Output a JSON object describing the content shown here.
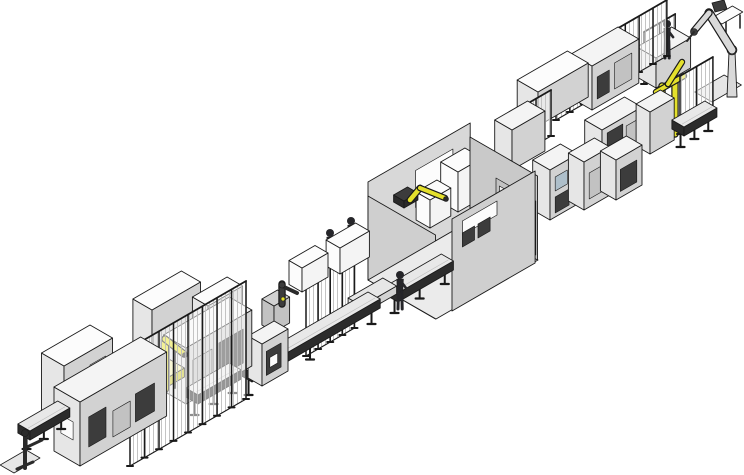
{
  "scene": {
    "kind": "isometric-cad-render",
    "subject": "automated production assembly line",
    "canvas_width": 744,
    "canvas_height": 475,
    "background": "#ffffff"
  },
  "palette": {
    "ink": "#1a1a1a",
    "top": "#f4f4f4",
    "end": "#e6e6e6",
    "long": "#d2d2d2",
    "longDark": "#c2c2c2",
    "white": "#fcfcfc",
    "dark": "#3c3c3c",
    "darker": "#2a2a2a",
    "wall": "#d8d8d8",
    "wallSide": "#c9c9c9",
    "wallFront": "#cfcfcf",
    "floor": "#ebebeb",
    "belt": "#e8e8e8",
    "frame": "#2c2c2c",
    "yellow": "#e4e02c",
    "yellowDark": "#c9c52a",
    "paleYellow": "#f2f0aa",
    "metal": "#d9d9d9",
    "screen": "#aebfca",
    "figure": "#26262a",
    "meshLine": "#bdbdbd"
  },
  "elements": [
    {
      "id": "safety-frame-top",
      "type": "fence",
      "o": [
        644,
        84
      ],
      "l": 36,
      "h": 52
    },
    {
      "id": "operator-platform",
      "type": "box",
      "o": [
        656,
        88
      ],
      "l": 40,
      "t": 22,
      "h": 30
    },
    {
      "id": "top-operator-figure",
      "type": "figure",
      "p": [
        667,
        58
      ],
      "hgt": 38
    },
    {
      "id": "side-table-leg-1",
      "type": "seg",
      "pts": [
        [
          726,
          34
        ],
        [
          726,
          21
        ]
      ],
      "w": 1.5,
      "c": "ink"
    },
    {
      "id": "side-table-leg-2",
      "type": "seg",
      "pts": [
        [
          740,
          28
        ],
        [
          740,
          15
        ]
      ],
      "w": 1.5,
      "c": "ink"
    },
    {
      "id": "side-table-top",
      "type": "plate",
      "o": [
        722,
        24
      ],
      "l": 24,
      "t": 12,
      "c": "white"
    },
    {
      "id": "pedestal-robot-base-plate",
      "type": "plate",
      "o": [
        712,
        102
      ],
      "l": 34,
      "t": 20,
      "c": "end"
    },
    {
      "id": "pedestal-robot-column",
      "type": "quad",
      "pts": [
        [
          727,
          97
        ],
        [
          737,
          97
        ],
        [
          735,
          52
        ],
        [
          729,
          52
        ]
      ],
      "c": "metal"
    },
    {
      "id": "pedestal-robot-shoulder",
      "type": "circle",
      "p": [
        732,
        50
      ],
      "r": 5,
      "c": "long"
    },
    {
      "id": "pedestal-robot-upper-arm",
      "type": "oseg",
      "pts": [
        [
          732,
          50
        ],
        [
          709,
          13
        ]
      ],
      "w": 7,
      "c": "metal"
    },
    {
      "id": "pedestal-robot-counterweight",
      "type": "quad",
      "pts": [
        [
          712,
          3
        ],
        [
          724,
          0
        ],
        [
          727,
          9
        ],
        [
          715,
          12
        ]
      ],
      "c": "dark"
    },
    {
      "id": "pedestal-robot-forearm",
      "type": "oseg",
      "pts": [
        [
          709,
          13
        ],
        [
          694,
          31
        ]
      ],
      "w": 5,
      "c": "metal"
    },
    {
      "id": "pedestal-robot-wrist",
      "type": "circle",
      "p": [
        694,
        32
      ],
      "r": 3.5,
      "c": "dark"
    },
    {
      "id": "pedestal-robot-tool",
      "type": "seg",
      "pts": [
        [
          694,
          32
        ],
        [
          687,
          41
        ]
      ],
      "w": 2,
      "c": "darker"
    },
    {
      "id": "upper-fence-row",
      "type": "fence",
      "o": [
        556,
        120
      ],
      "l": 128,
      "h": 56
    },
    {
      "id": "upper-module-rear",
      "type": "box",
      "o": [
        592,
        110
      ],
      "l": 54,
      "t": 24,
      "h": 44,
      "panels": [
        {
          "f": "a",
          "r": [
            6,
            8,
            20,
            30
          ],
          "c": "dark"
        },
        {
          "f": "a",
          "r": [
            26,
            8,
            46,
            34
          ],
          "c": "longDark"
        }
      ]
    },
    {
      "id": "gantry-base",
      "type": "box",
      "o": [
        652,
        148
      ],
      "l": 34,
      "t": 18,
      "h": 10,
      "c": {
        "top": "paleYellow",
        "end": "paleYellow",
        "long": "yellowDark"
      }
    },
    {
      "id": "gantry-column-1",
      "type": "yseg",
      "pts": [
        [
          662,
          140
        ],
        [
          662,
          86
        ]
      ],
      "w": 5
    },
    {
      "id": "gantry-column-2",
      "type": "yseg",
      "pts": [
        [
          675,
          134
        ],
        [
          675,
          80
        ]
      ],
      "w": 5
    },
    {
      "id": "gantry-crossbar",
      "type": "yseg",
      "pts": [
        [
          656,
          92
        ],
        [
          684,
          76
        ]
      ],
      "w": 4
    },
    {
      "id": "gantry-joint",
      "type": "circle",
      "p": [
        668,
        84
      ],
      "r": 3,
      "c": "darker"
    },
    {
      "id": "gantry-arm",
      "type": "yseg",
      "pts": [
        [
          668,
          84
        ],
        [
          682,
          62
        ]
      ],
      "w": 4
    },
    {
      "id": "upper-module-front",
      "type": "box",
      "o": [
        538,
        126
      ],
      "l": 58,
      "t": 24,
      "h": 34,
      "c": {
        "top": "white"
      }
    },
    {
      "id": "safety-frame-right",
      "type": "fence",
      "o": [
        680,
        134
      ],
      "l": 38,
      "h": 58
    },
    {
      "id": "upper-cabinet-doors",
      "type": "box",
      "o": [
        602,
        172
      ],
      "l": 46,
      "t": 20,
      "h": 42,
      "panels": [
        {
          "f": "a",
          "r": [
            6,
            4,
            24,
            36
          ],
          "c": "dark"
        },
        {
          "f": "a",
          "r": [
            28,
            6,
            42,
            32
          ],
          "c": "longDark"
        }
      ]
    },
    {
      "id": "upper-cabinet-small",
      "type": "box",
      "o": [
        650,
        154
      ],
      "l": 28,
      "t": 16,
      "h": 42
    },
    {
      "id": "upper-conveyor",
      "type": "conveyor",
      "o": [
        684,
        152
      ],
      "l": 38,
      "z": 16
    },
    {
      "id": "behind-room-fence",
      "type": "fence",
      "o": [
        506,
        162
      ],
      "l": 52,
      "h": 46
    },
    {
      "id": "behind-room-module",
      "type": "box",
      "o": [
        512,
        170
      ],
      "l": 38,
      "t": 20,
      "h": 40
    },
    {
      "id": "screen-cabinet",
      "type": "box",
      "o": [
        550,
        220
      ],
      "l": 32,
      "t": 20,
      "h": 50,
      "panels": [
        {
          "f": "a",
          "r": [
            6,
            26,
            20,
            40
          ],
          "c": "screen"
        },
        {
          "f": "a",
          "r": [
            6,
            4,
            22,
            20
          ],
          "c": "dark"
        }
      ]
    },
    {
      "id": "outfeed-cabinet-1",
      "type": "box",
      "o": [
        584,
        210
      ],
      "l": 30,
      "t": 18,
      "h": 48,
      "panels": [
        {
          "f": "a",
          "r": [
            6,
            8,
            22,
            34
          ],
          "c": "longDark"
        }
      ]
    },
    {
      "id": "outfeed-cabinet-2",
      "type": "box",
      "o": [
        616,
        200
      ],
      "l": 30,
      "t": 18,
      "h": 40,
      "panels": [
        {
          "f": "a",
          "r": [
            5,
            6,
            24,
            28
          ],
          "c": "dark"
        }
      ]
    },
    {
      "id": "room-back-wall",
      "type": "wallA",
      "o": [
        368,
        280
      ],
      "l": 118,
      "h": 98,
      "c": "wall",
      "windows": [
        {
          "r": [
            55,
            45,
            98,
            82
          ],
          "c": "white"
        }
      ]
    },
    {
      "id": "room-left-wall",
      "type": "wallB",
      "o": [
        368,
        280
      ],
      "t": 78,
      "h": 84,
      "c": "wallFront"
    },
    {
      "id": "room-floor",
      "type": "quad",
      "pts": [
        [
          368,
          280
        ],
        [
          470,
          221
        ],
        [
          538,
          260
        ],
        [
          436,
          319
        ]
      ],
      "c": "floor"
    },
    {
      "id": "room-box-tall",
      "type": "box",
      "o": [
        458,
        212
      ],
      "l": 28,
      "t": 20,
      "h": 40,
      "c": {
        "top": "white",
        "end": "white",
        "long": "top"
      }
    },
    {
      "id": "room-box-small",
      "type": "box",
      "o": [
        430,
        228
      ],
      "l": 24,
      "t": 16,
      "h": 28,
      "c": {
        "top": "white",
        "end": "white",
        "long": "top"
      }
    },
    {
      "id": "room-box-right",
      "type": "box",
      "o": [
        492,
        238
      ],
      "l": 30,
      "t": 20,
      "h": 36,
      "c": {
        "top": "white",
        "end": "white",
        "long": "top"
      }
    },
    {
      "id": "room-robot-base",
      "type": "box",
      "o": [
        404,
        208
      ],
      "l": 16,
      "t": 12,
      "h": 7,
      "c": {
        "top": "dark",
        "end": "darker",
        "long": "darker"
      }
    },
    {
      "id": "room-robot-link-1",
      "type": "yseg",
      "pts": [
        [
          410,
          200
        ],
        [
          420,
          188
        ]
      ],
      "w": 4.5
    },
    {
      "id": "room-robot-link-2",
      "type": "yseg",
      "pts": [
        [
          420,
          188
        ],
        [
          445,
          198
        ]
      ],
      "w": 4
    },
    {
      "id": "room-robot-wrist",
      "type": "circle",
      "p": [
        446,
        199
      ],
      "r": 2.5,
      "c": "darker"
    },
    {
      "id": "room-right-wall",
      "type": "wallB",
      "o": [
        470,
        221
      ],
      "t": 78,
      "h": 84,
      "c": "wallSide",
      "windows": [
        {
          "r": [
            30,
            4,
            52,
            58
          ],
          "c": "longDark"
        },
        {
          "r": [
            56,
            4,
            76,
            58
          ],
          "c": "longDark"
        },
        {
          "r": [
            34,
            28,
            48,
            52
          ],
          "c": "top"
        },
        {
          "r": [
            60,
            28,
            72,
            52
          ],
          "c": "top"
        }
      ]
    },
    {
      "id": "room-front-wall",
      "type": "wallA",
      "o": [
        452,
        311
      ],
      "l": 96,
      "h": 92,
      "c": "wallFront",
      "windows": [
        {
          "r": [
            12,
            70,
            52,
            84
          ],
          "c": "white"
        },
        {
          "r": [
            12,
            58,
            26,
            72
          ],
          "c": "dark"
        },
        {
          "r": [
            30,
            58,
            44,
            72
          ],
          "c": "dark"
        }
      ]
    },
    {
      "id": "room-infeed-conveyor",
      "type": "conveyor",
      "o": [
        398,
        318
      ],
      "l": 64,
      "z": 16
    },
    {
      "id": "operator-figure-3",
      "type": "figure",
      "p": [
        400,
        309
      ],
      "hgt": 38
    },
    {
      "id": "mid-fence",
      "type": "fence",
      "o": [
        306,
        356
      ],
      "l": 56,
      "h": 85
    },
    {
      "id": "operator-figure-2",
      "type": "figure",
      "p": [
        351,
        255
      ],
      "hgt": 38
    },
    {
      "id": "operator-figure-1",
      "type": "figure",
      "p": [
        330,
        267
      ],
      "hgt": 38
    },
    {
      "id": "bench-box-2",
      "type": "box",
      "o": [
        340,
        274
      ],
      "l": 34,
      "t": 16,
      "h": 26,
      "c": {
        "top": "white",
        "end": "white",
        "long": "top"
      }
    },
    {
      "id": "bench-box-1",
      "type": "box",
      "o": [
        302,
        292
      ],
      "l": 30,
      "t": 15,
      "h": 24,
      "c": {
        "top": "white",
        "end": "white",
        "long": "top"
      }
    },
    {
      "id": "walkway",
      "type": "box",
      "o": [
        362,
        314
      ],
      "l": 40,
      "t": 16,
      "h": 8,
      "c": {
        "top": "end"
      }
    },
    {
      "id": "turntable-robot-stand",
      "type": "box",
      "o": [
        274,
        332
      ],
      "l": 18,
      "t": 14,
      "h": 26,
      "c": {
        "top": "long",
        "end": "longDark",
        "long": "longDark"
      }
    },
    {
      "id": "turntable-robot-body",
      "type": "oseg",
      "pts": [
        [
          282,
          304
        ],
        [
          282,
          284
        ]
      ],
      "w": 5,
      "c": "dark"
    },
    {
      "id": "turntable-robot-arm",
      "type": "seg",
      "pts": [
        [
          282,
          286
        ],
        [
          297,
          293
        ]
      ],
      "w": 4,
      "c": "darker"
    },
    {
      "id": "turntable-robot-joint",
      "type": "circle",
      "p": [
        282,
        285
      ],
      "r": 3,
      "c": "dark"
    },
    {
      "id": "turntable-robot-marker",
      "type": "circle",
      "p": [
        283,
        299
      ],
      "r": 2,
      "c": "yellow"
    },
    {
      "id": "mid-conveyor",
      "type": "conveyor",
      "o": [
        252,
        400
      ],
      "l": 148,
      "z": 18
    },
    {
      "id": "mid-cabinet",
      "type": "box",
      "o": [
        262,
        386
      ],
      "l": 30,
      "t": 16,
      "h": 42,
      "panels": [
        {
          "f": "a",
          "r": [
            5,
            8,
            22,
            32
          ],
          "c": "dark"
        },
        {
          "f": "a",
          "r": [
            9,
            14,
            18,
            24
          ],
          "c": "white"
        }
      ]
    },
    {
      "id": "cell-cabinet-rear-1",
      "type": "box",
      "o": [
        152,
        366
      ],
      "l": 56,
      "t": 22,
      "h": 56,
      "c": {
        "top": "white"
      }
    },
    {
      "id": "cell-cabinet-rear-2",
      "type": "box",
      "o": [
        208,
        354
      ],
      "l": 40,
      "t": 18,
      "h": 48,
      "c": {
        "top": "white"
      }
    },
    {
      "id": "cell-station-cabinet",
      "type": "box",
      "o": [
        186,
        404
      ],
      "l": 76,
      "t": 26,
      "h": 56,
      "panels": [
        {
          "f": "a",
          "r": [
            8,
            10,
            30,
            40
          ],
          "c": "longDark"
        },
        {
          "f": "a",
          "r": [
            38,
            8,
            66,
            42
          ],
          "c": "dark"
        }
      ]
    },
    {
      "id": "cell-robot-base",
      "type": "box",
      "o": [
        148,
        398
      ],
      "l": 42,
      "t": 24,
      "h": 9,
      "c": {
        "top": "paleYellow",
        "end": "paleYellow",
        "long": "yellowDark"
      }
    },
    {
      "id": "cell-robot-post",
      "type": "seg",
      "pts": [
        [
          175,
          388
        ],
        [
          175,
          348
        ]
      ],
      "w": 2,
      "c": "darker"
    },
    {
      "id": "cell-robot-column",
      "type": "yseg",
      "pts": [
        [
          165,
          389
        ],
        [
          165,
          340
        ]
      ],
      "w": 6
    },
    {
      "id": "cell-robot-shoulder",
      "type": "circle",
      "p": [
        165,
        339
      ],
      "r": 3.5,
      "c": "darker"
    },
    {
      "id": "cell-robot-arm",
      "type": "yseg",
      "pts": [
        [
          165,
          339
        ],
        [
          184,
          354
        ]
      ],
      "w": 5
    },
    {
      "id": "cell-robot-wrist",
      "type": "circle",
      "p": [
        185,
        355
      ],
      "r": 2.5,
      "c": "darker"
    },
    {
      "id": "link-conveyor",
      "type": "conveyor",
      "o": [
        198,
        420
      ],
      "l": 50,
      "z": 16
    },
    {
      "id": "cell-front-fence",
      "type": "fence",
      "o": [
        130,
        466
      ],
      "l": 134,
      "h": 118
    },
    {
      "id": "infeed-cabinet-top",
      "type": "box",
      "o": [
        64,
        424
      ],
      "l": 56,
      "t": 26,
      "h": 58,
      "c": {
        "top": "white"
      },
      "panels": [
        {
          "f": "a",
          "r": [
            30,
            20,
            48,
            44
          ],
          "c": "top"
        }
      ]
    },
    {
      "id": "infeed-cabinet-main",
      "type": "box",
      "o": [
        80,
        466
      ],
      "l": 100,
      "t": 30,
      "h": 64,
      "panels": [
        {
          "f": "a",
          "r": [
            10,
            14,
            30,
            44
          ],
          "c": "dark"
        },
        {
          "f": "a",
          "r": [
            38,
            10,
            58,
            36
          ],
          "c": "longDark"
        },
        {
          "f": "a",
          "r": [
            64,
            12,
            86,
            40
          ],
          "c": "dark"
        },
        {
          "f": "e",
          "r": [
            8,
            22,
            22,
            40
          ],
          "c": "white"
        }
      ]
    },
    {
      "id": "infeed-conveyor",
      "type": "conveyor",
      "o": [
        30,
        454
      ],
      "l": 46,
      "z": 14
    },
    {
      "id": "loader-base-plate",
      "type": "plate",
      "o": [
        14,
        473
      ],
      "l": 30,
      "t": 16,
      "c": "end"
    },
    {
      "id": "loader-robot-column",
      "type": "seg",
      "pts": [
        [
          25,
          468
        ],
        [
          25,
          436
        ]
      ],
      "w": 4,
      "c": "darker"
    },
    {
      "id": "loader-robot-head",
      "type": "circle",
      "p": [
        25,
        433
      ],
      "r": 3.5,
      "c": "darker"
    },
    {
      "id": "loader-robot-arm",
      "type": "seg",
      "pts": [
        [
          25,
          448
        ],
        [
          42,
          440
        ]
      ],
      "w": 3,
      "c": "darker"
    },
    {
      "id": "loader-robot-foot",
      "type": "seg",
      "pts": [
        [
          17,
          469
        ],
        [
          33,
          462
        ]
      ],
      "w": 3,
      "c": "darker"
    }
  ]
}
